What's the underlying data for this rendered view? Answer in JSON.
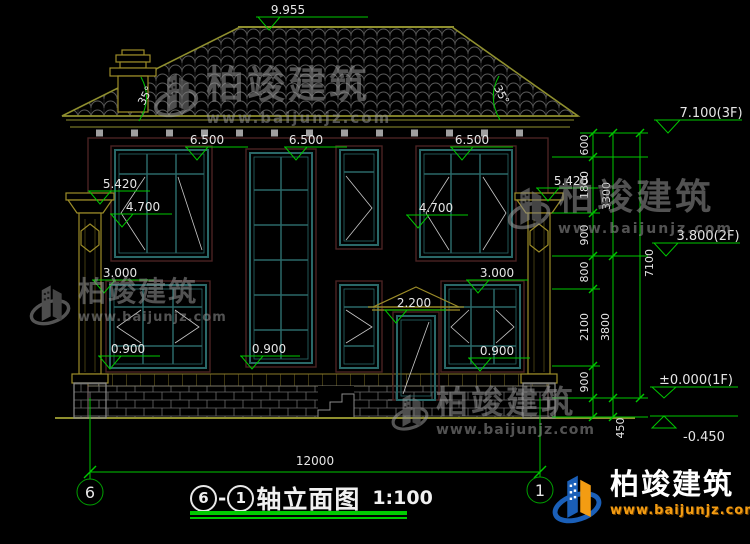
{
  "title": {
    "axis_left": "6",
    "dash": "-",
    "axis_right": "1",
    "text": "轴立面图",
    "scale": "1:100"
  },
  "axes": {
    "left_bubble": "6",
    "right_bubble": "1"
  },
  "watermark": {
    "brand": "柏竣建筑",
    "url": "www.baijunjz.com"
  },
  "logo": {
    "brand": "柏竣建筑",
    "url": "www.baijunjz.com"
  },
  "elevations": {
    "ridge": "9.955",
    "eave1": "6.500",
    "eave2": "6.500",
    "eave3": "6.500",
    "left_5420": "5.420",
    "left_4700": "4.700",
    "right_5420": "5.420",
    "right_4700": "4.700",
    "left_3000": "3.000",
    "right_3000": "3.000",
    "door_2200": "2.200",
    "left_0900": "0.900",
    "stair_0900": "0.900",
    "right_0900": "0.900",
    "f3": "7.100(3F)",
    "f2": "3.800(2F)",
    "f1": "±0.000(1F)",
    "base": "-0.450"
  },
  "angles": {
    "left": "35°",
    "right": "35°"
  },
  "dims": {
    "total_width": "12000",
    "chain": [
      "600",
      "1800",
      "900",
      "800",
      "2100",
      "900",
      "450"
    ],
    "subtotals": [
      "3300",
      "3800"
    ],
    "total_height": "7100"
  },
  "colors": {
    "dim_green": "#00c800",
    "arch_yellow": "#9c8c28",
    "window_teal": "#2a6868",
    "brand_blue": "#1a5fb8",
    "brand_orange": "#f39c12"
  }
}
